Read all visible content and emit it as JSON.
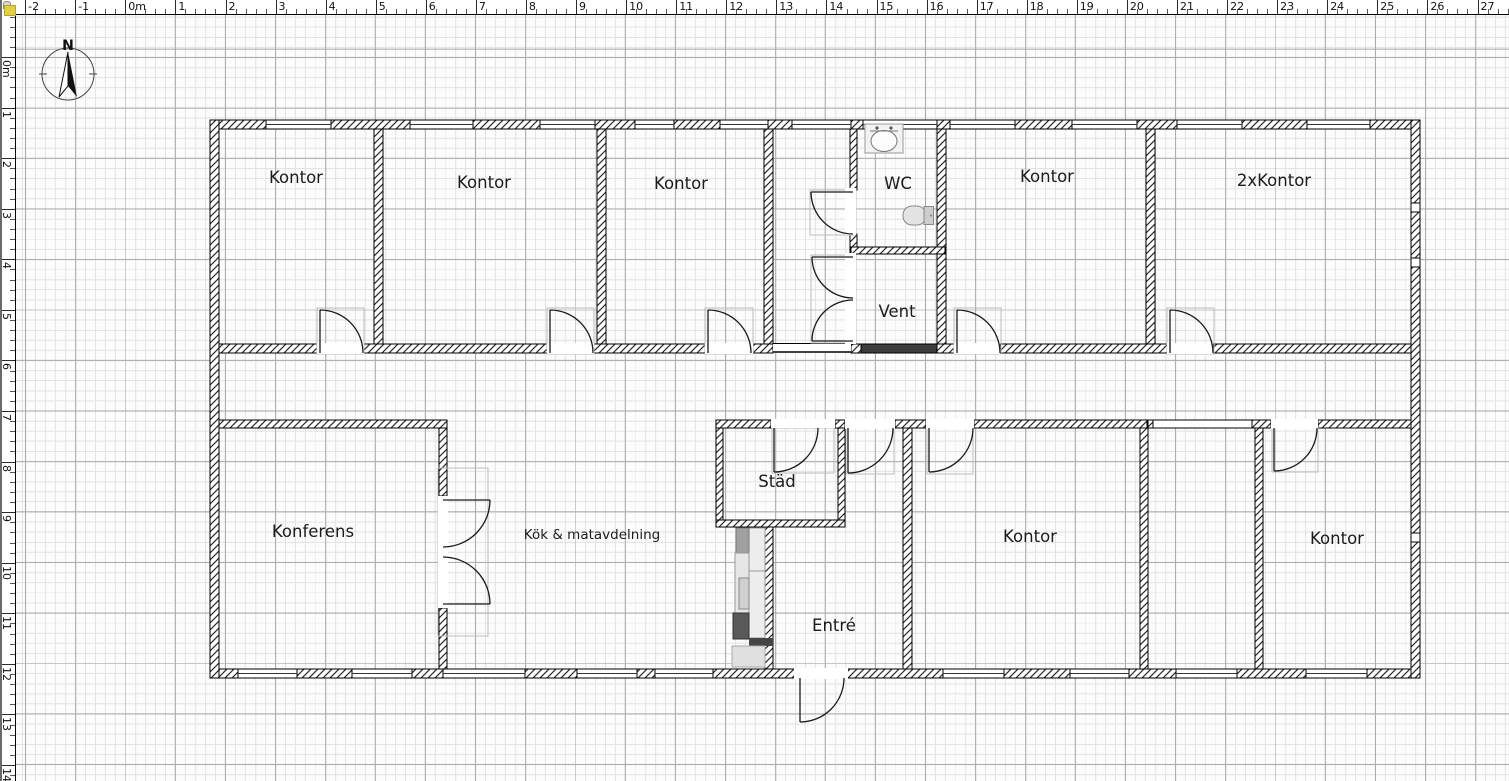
{
  "app": {
    "view": "floor-plan-canvas"
  },
  "rulers": {
    "horizontal": {
      "labels": [
        "-2",
        "-1",
        "0m",
        "1",
        "2",
        "3",
        "4",
        "5",
        "6",
        "7",
        "8",
        "9",
        "10",
        "11",
        "12",
        "13",
        "14",
        "15",
        "16",
        "17",
        "18",
        "19",
        "20",
        "21",
        "22",
        "23",
        "24",
        "25",
        "26",
        "27"
      ]
    },
    "vertical": {
      "labels": [
        "0m",
        "1",
        "2",
        "3",
        "4",
        "5",
        "6",
        "7",
        "8",
        "9",
        "10",
        "11",
        "12",
        "13",
        "14"
      ]
    }
  },
  "compass": {
    "label": "N"
  },
  "plan": {
    "rooms": [
      {
        "id": "kontor-1",
        "label": "Kontor"
      },
      {
        "id": "kontor-2",
        "label": "Kontor"
      },
      {
        "id": "kontor-3",
        "label": "Kontor"
      },
      {
        "id": "wc",
        "label": "WC"
      },
      {
        "id": "vent",
        "label": "Vent"
      },
      {
        "id": "kontor-4",
        "label": "Kontor"
      },
      {
        "id": "kontor-double",
        "label": "2xKontor"
      },
      {
        "id": "konferens",
        "label": "Konferens"
      },
      {
        "id": "kok-matavdelning",
        "label": "Kök & matavdelning"
      },
      {
        "id": "stad",
        "label": "Städ"
      },
      {
        "id": "entre",
        "label": "Entré"
      },
      {
        "id": "kontor-5",
        "label": "Kontor"
      },
      {
        "id": "kontor-6",
        "label": "Kontor"
      }
    ],
    "fixtures": [
      "wc-sink",
      "wc-toilet",
      "kitchen-counter",
      "stove"
    ],
    "colors": {
      "wall_line": "#000000",
      "grid_minor": "#e3e3e3",
      "grid_major": "#ababab",
      "door_casing": "#bdbdbd",
      "stove_dark": "#595959",
      "fixture_gray": "#e8e8e8"
    }
  }
}
